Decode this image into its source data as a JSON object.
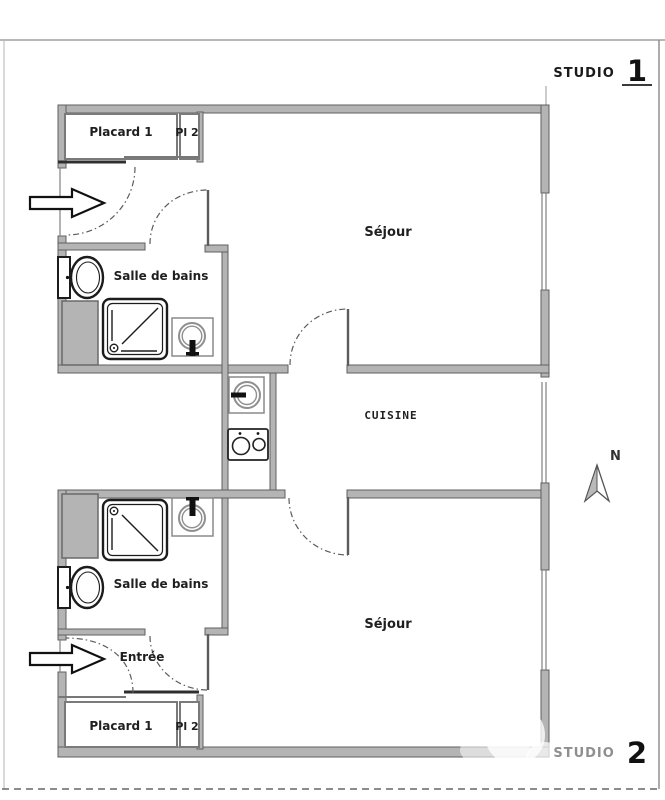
{
  "title": {
    "studio1_word": "STUDIO",
    "studio1_number": "1",
    "studio2_word": "STUDIO",
    "studio2_number": "2"
  },
  "studio1": {
    "placard": "Placard 1",
    "closet2": "Pl 2",
    "living": "Séjour",
    "bathroom": "Salle de bains"
  },
  "kitchen": {
    "label": "CUISINE"
  },
  "studio2": {
    "bathroom": "Salle de bains",
    "entry": "Entrée",
    "living": "Séjour",
    "placard": "Placard 1",
    "closet2": "Pl 2"
  },
  "compass": {
    "north": "N"
  },
  "colors": {
    "wall": "#b4b4b4",
    "text": "#1f1f1f",
    "faded_text": "#8f8f8f"
  }
}
